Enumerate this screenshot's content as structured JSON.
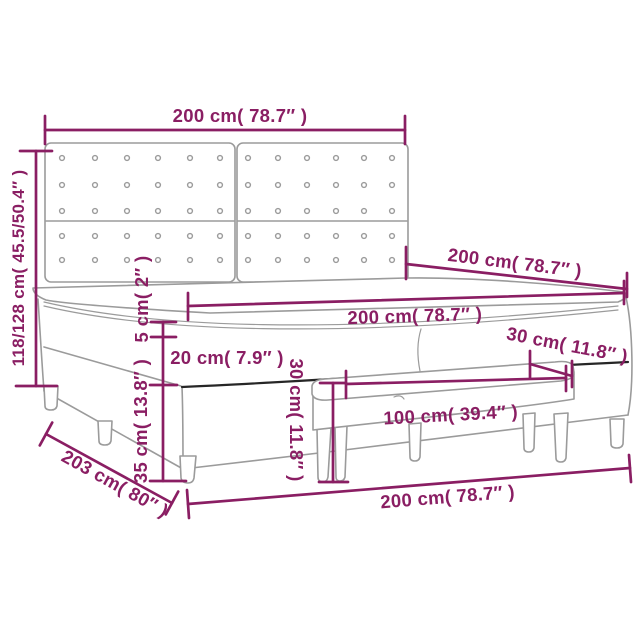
{
  "colors": {
    "dimension": "#8a1e63",
    "structure": "#9b9b9b",
    "dark_edge": "#262626",
    "background": "#ffffff"
  },
  "dimensions": {
    "headboard_width": "200 cm( 78.7″ )",
    "headboard_height": "118/128 cm( 45.5/50.4″ )",
    "bed_length": "200 cm( 78.7″ )",
    "mattress_width": "200 cm( 78.7″ )",
    "topper_thickness": "5 cm( 2″ )",
    "mattress_thickness": "20 cm( 7.9″ )",
    "base_height": "35 cm( 13.8″ )",
    "bench_height": "30 cm( 11.8″ )",
    "bench_depth": "30 cm( 11.8″ )",
    "bench_width": "100 cm( 39.4″ )",
    "total_length": "203 cm( 80″ )",
    "bed_width": "200 cm( 78.7″ )"
  }
}
